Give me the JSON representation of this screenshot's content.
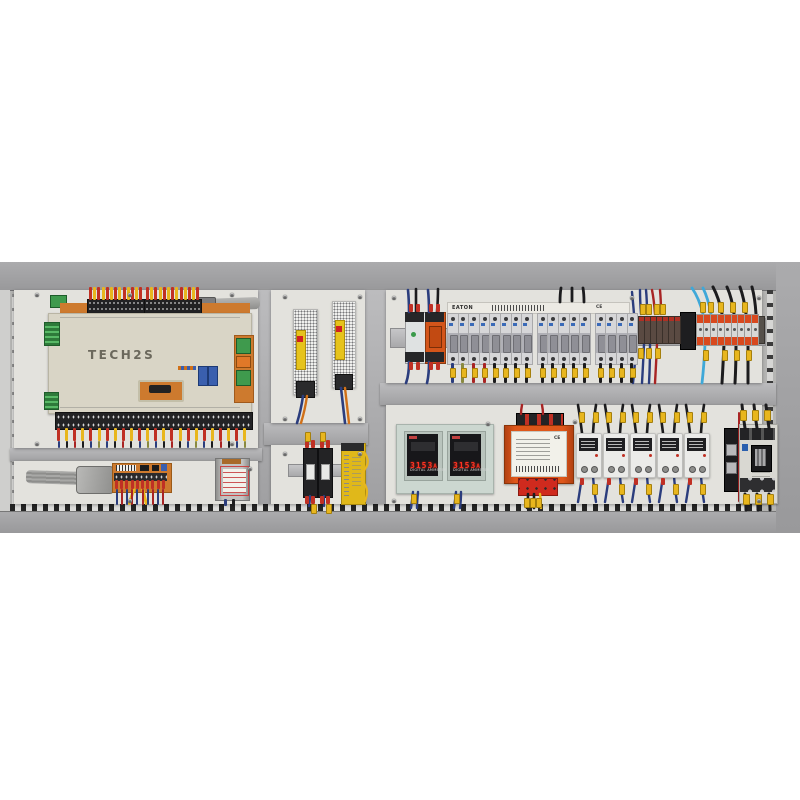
{
  "plc": {
    "label": "TECH2S"
  },
  "breakers": {
    "brand": "EATON",
    "ce_mark": "CE",
    "groups": [
      8,
      5,
      4
    ]
  },
  "meters": {
    "display": "3153",
    "unit": "A",
    "caption": "DIGITAL AMMETER"
  },
  "transformer": {
    "ce_mark": "CE"
  },
  "colors": {
    "interior": "#b4b4b2",
    "band": "#99999b",
    "bandHi": "#ababad",
    "panel": "#e3e2dd",
    "beam": "#a0a0a2",
    "beamHi": "#bcbcbe",
    "plc": "#d9d5c6",
    "plcText": "#6b685c",
    "pcbOrange": "#cd7a2e",
    "ferruleRed": "#c03024",
    "ferruleYellow": "#e8b61e",
    "wireNavy": "#2b3d7d",
    "wireBlack": "#1c1c1e",
    "wireRed": "#a82424",
    "wireCyan": "#3fa8d8",
    "wireOlive": "#8a8a40",
    "wireOrange": "#d07018",
    "wireGray": "#9c9c9a",
    "rail": "#c6c6c8",
    "mcb": "#d6d6d8",
    "mcbBand": "#b0b0b6",
    "mcbToggle": "#8f8f96",
    "relayOrange": "#d4551a",
    "psu": "#f0f0ee",
    "psuLabel": "#e6c31c",
    "safetyYellow": "#e0b81a",
    "meterPlate": "#ccd7d0",
    "meterFace": "#17171a",
    "meterRed": "#ff3222",
    "meterFrame": "#b9c4bd",
    "xfmrOrange": "#df571a",
    "labelPaper": "#f2f1ea",
    "redBlock": "#cf2a1e",
    "ssrBody": "#ebebe9",
    "ssrLabel": "#1f1f22",
    "contactor": "#d9d8d2",
    "contactorWin": "#1a1a1c",
    "termOrange": "#d8491e",
    "termDark": "#5a4a42",
    "green": "#3f9a4d",
    "blueDip": "#3a5fae"
  },
  "layout": {
    "plc_top_ferrules": 13,
    "plc_bottom_ferrules": 24,
    "pcb_ferrules": 10,
    "breaker_start_x": 447,
    "breaker_width": 10.6,
    "breaker_wire_colors": [
      "navy",
      "olive",
      "red",
      "red",
      "black",
      "black",
      "black",
      "black",
      "black",
      "black",
      "black",
      "black",
      "black",
      "black",
      "black",
      "black",
      "black"
    ],
    "dark_terms": 7,
    "orange_terms": 9,
    "ssr_xs": [
      576,
      603,
      630,
      657,
      684
    ],
    "contactor_wire_xs": [
      745,
      757,
      769
    ],
    "screws": [
      [
        35,
        31
      ],
      [
        128,
        31
      ],
      [
        230,
        31
      ],
      [
        35,
        180
      ],
      [
        230,
        180
      ],
      [
        283,
        33
      ],
      [
        358,
        33
      ],
      [
        283,
        155
      ],
      [
        358,
        155
      ],
      [
        283,
        190
      ],
      [
        358,
        190
      ],
      [
        392,
        34
      ],
      [
        630,
        34
      ],
      [
        757,
        34
      ],
      [
        486,
        160
      ],
      [
        573,
        158
      ],
      [
        392,
        237
      ],
      [
        757,
        237
      ],
      [
        128,
        237
      ],
      [
        248,
        205
      ]
    ]
  }
}
